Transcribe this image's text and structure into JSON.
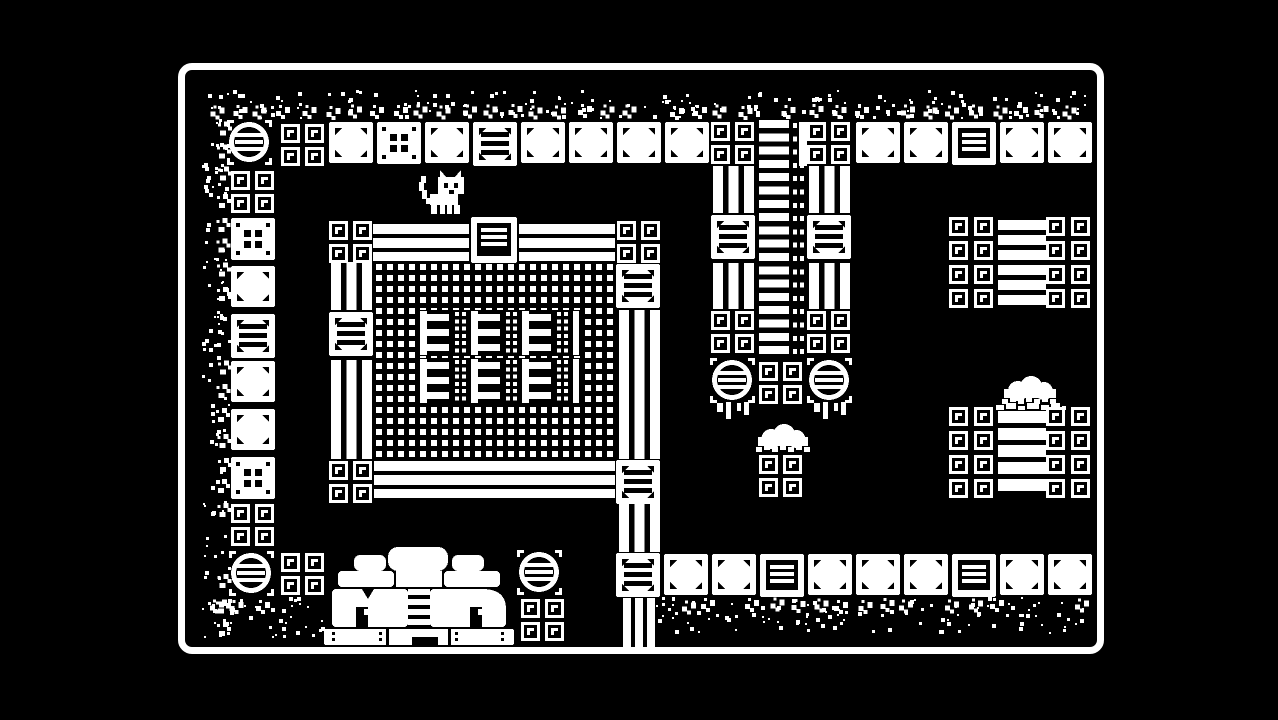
{
  "meta": {
    "title": "1-bit dungeon room",
    "style": "1-bit pixel art"
  },
  "palette": {
    "background": "#000000",
    "ink": "#ffffff"
  },
  "viewport": {
    "width": 1278,
    "height": 720
  },
  "frame": {
    "x": 178,
    "y": 63,
    "w": 926,
    "h": 591,
    "border": 7,
    "radius": 14
  },
  "sprites": [
    {
      "t": "speck",
      "x": 206,
      "y": 90,
      "w": 886,
      "h": 30,
      "seed": 7,
      "edge": "top"
    },
    {
      "t": "speck",
      "x": 202,
      "y": 118,
      "w": 30,
      "h": 522,
      "seed": 11,
      "edge": "left"
    },
    {
      "t": "speck",
      "x": 206,
      "y": 597,
      "w": 122,
      "h": 42,
      "seed": 23,
      "edge": "bottom"
    },
    {
      "t": "speck",
      "x": 656,
      "y": 597,
      "w": 440,
      "h": 38,
      "seed": 31,
      "edge": "bottom"
    },
    {
      "t": "circle",
      "x": 227,
      "y": 120
    },
    {
      "t": "sq2",
      "x": 281,
      "y": 124
    },
    {
      "t": "plate",
      "x": 329,
      "y": 122
    },
    {
      "t": "dice",
      "x": 377,
      "y": 122
    },
    {
      "t": "plate",
      "x": 425,
      "y": 122
    },
    {
      "t": "rungs",
      "x": 473,
      "y": 122
    },
    {
      "t": "plate",
      "x": 521,
      "y": 122
    },
    {
      "t": "plate",
      "x": 569,
      "y": 122
    },
    {
      "t": "plate",
      "x": 617,
      "y": 122
    },
    {
      "t": "plate",
      "x": 665,
      "y": 122
    },
    {
      "t": "sq2",
      "x": 711,
      "y": 122
    },
    {
      "t": "sq2",
      "x": 807,
      "y": 122
    },
    {
      "t": "plate",
      "x": 856,
      "y": 122
    },
    {
      "t": "plate",
      "x": 904,
      "y": 122
    },
    {
      "t": "crate",
      "x": 952,
      "y": 122
    },
    {
      "t": "plate",
      "x": 1000,
      "y": 122
    },
    {
      "t": "plate",
      "x": 1048,
      "y": 122
    },
    {
      "t": "sq2",
      "x": 231,
      "y": 171
    },
    {
      "t": "dice",
      "x": 231,
      "y": 218
    },
    {
      "t": "plate",
      "x": 231,
      "y": 266
    },
    {
      "t": "rungs",
      "x": 231,
      "y": 314
    },
    {
      "t": "plate",
      "x": 231,
      "y": 361
    },
    {
      "t": "plate",
      "x": 231,
      "y": 409
    },
    {
      "t": "dice",
      "x": 231,
      "y": 457
    },
    {
      "t": "sq2",
      "x": 231,
      "y": 504
    },
    {
      "t": "circle",
      "x": 229,
      "y": 551
    },
    {
      "t": "sq2",
      "x": 281,
      "y": 553
    },
    {
      "t": "sq2",
      "x": 329,
      "y": 221
    },
    {
      "t": "hbeam",
      "x": 373,
      "y": 224,
      "w": 96
    },
    {
      "t": "crate",
      "x": 471,
      "y": 217,
      "w": 46,
      "h": 46
    },
    {
      "t": "hbeam",
      "x": 519,
      "y": 224,
      "w": 96
    },
    {
      "t": "sq2",
      "x": 617,
      "y": 221
    },
    {
      "t": "vbeam",
      "x": 331,
      "y": 262,
      "h": 48
    },
    {
      "t": "rungs",
      "x": 329,
      "y": 312
    },
    {
      "t": "vbeam",
      "x": 331,
      "y": 360,
      "h": 99
    },
    {
      "t": "sq2",
      "x": 329,
      "y": 461
    },
    {
      "t": "mesh",
      "x": 376,
      "y": 264,
      "w": 238,
      "h": 196
    },
    {
      "t": "erow",
      "x": 420,
      "y": 310
    },
    {
      "t": "erow",
      "x": 420,
      "y": 358
    },
    {
      "t": "hbeam",
      "x": 374,
      "y": 461,
      "w": 241
    },
    {
      "t": "rungs",
      "x": 616,
      "y": 264
    },
    {
      "t": "vbeam",
      "x": 619,
      "y": 310,
      "h": 149
    },
    {
      "t": "rungs",
      "x": 616,
      "y": 460
    },
    {
      "t": "vbeam",
      "x": 619,
      "y": 502,
      "h": 50
    },
    {
      "t": "rungs",
      "x": 616,
      "y": 553
    },
    {
      "t": "vbeam",
      "x": 623,
      "y": 598,
      "w": 32,
      "h": 52
    },
    {
      "t": "vbeam",
      "x": 713,
      "y": 166,
      "h": 47
    },
    {
      "t": "rungs",
      "x": 711,
      "y": 215
    },
    {
      "t": "vbeam",
      "x": 713,
      "y": 263,
      "h": 46
    },
    {
      "t": "sq2",
      "x": 711,
      "y": 311
    },
    {
      "t": "laddercol",
      "x": 757,
      "y": 120
    },
    {
      "t": "vbeam",
      "x": 809,
      "y": 166,
      "h": 47
    },
    {
      "t": "rungs",
      "x": 807,
      "y": 215
    },
    {
      "t": "vbeam",
      "x": 809,
      "y": 263,
      "h": 46
    },
    {
      "t": "sq2",
      "x": 807,
      "y": 311
    },
    {
      "t": "circle",
      "x": 710,
      "y": 358,
      "v": "drips"
    },
    {
      "t": "sq2",
      "x": 759,
      "y": 362
    },
    {
      "t": "circle",
      "x": 807,
      "y": 358,
      "v": "drips"
    },
    {
      "t": "dome",
      "x": 754,
      "y": 424,
      "w": 58
    },
    {
      "t": "sq2",
      "x": 759,
      "y": 455
    },
    {
      "t": "sqgrid",
      "x": 949,
      "y": 217
    },
    {
      "t": "bars",
      "x": 998,
      "y": 220,
      "w": 48,
      "n": 6
    },
    {
      "t": "sqgrid",
      "x": 1046,
      "y": 217
    },
    {
      "t": "dome",
      "x": 1000,
      "y": 376,
      "w": 60
    },
    {
      "t": "driprow",
      "x": 996,
      "y": 403,
      "w": 70
    },
    {
      "t": "sqgrid",
      "x": 949,
      "y": 407
    },
    {
      "t": "bars",
      "x": 998,
      "y": 411,
      "w": 48,
      "n": 5,
      "bh": 12,
      "pitch": 17
    },
    {
      "t": "sqgrid",
      "x": 1046,
      "y": 407
    },
    {
      "t": "plate",
      "x": 664,
      "y": 554
    },
    {
      "t": "plate",
      "x": 712,
      "y": 554
    },
    {
      "t": "crate",
      "x": 760,
      "y": 554
    },
    {
      "t": "plate",
      "x": 808,
      "y": 554
    },
    {
      "t": "plate",
      "x": 856,
      "y": 554
    },
    {
      "t": "plate",
      "x": 904,
      "y": 554
    },
    {
      "t": "crate",
      "x": 952,
      "y": 554
    },
    {
      "t": "plate",
      "x": 1000,
      "y": 554
    },
    {
      "t": "plate",
      "x": 1048,
      "y": 554
    },
    {
      "t": "house",
      "x": 324,
      "y": 547
    },
    {
      "t": "circle",
      "x": 517,
      "y": 550
    },
    {
      "t": "sq2",
      "x": 521,
      "y": 599
    },
    {
      "t": "cat",
      "x": 416,
      "y": 170
    }
  ]
}
